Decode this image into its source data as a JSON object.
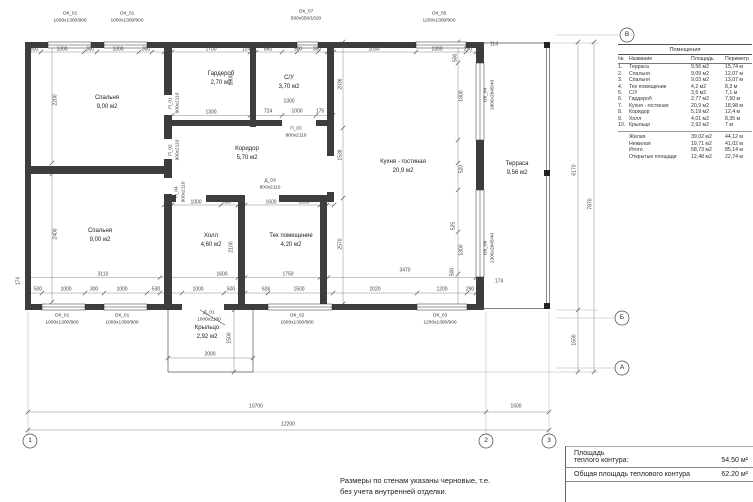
{
  "legend": {
    "title": "Помещения",
    "col_headers": [
      "№",
      "Название",
      "Площадь",
      "Периметр"
    ],
    "rows": [
      [
        "1.",
        "Терраса",
        "9,56 м2",
        "15,74 м"
      ],
      [
        "2.",
        "Спальня",
        "9,09 м2",
        "12,07 м"
      ],
      [
        "3.",
        "Спальня",
        "9,03 м2",
        "13,07 м"
      ],
      [
        "4.",
        "Тех помещение",
        "4,2 м2",
        "8,3 м"
      ],
      [
        "5.",
        "С/У",
        "3,5 м2",
        "7,1 м"
      ],
      [
        "6.",
        "Гардероб",
        "2,77 м2",
        "7,50 м"
      ],
      [
        "7.",
        "Кухня - гостиная",
        "20,9 м2",
        "18,98 м"
      ],
      [
        "8.",
        "Коридор",
        "5,19 м2",
        "12,4 м"
      ],
      [
        "9.",
        "Холл",
        "4,01 м2",
        "8,35 м"
      ],
      [
        "10.",
        "Крыльцо",
        "2,92 м2",
        "7 м"
      ]
    ],
    "summary": [
      [
        "Жилая",
        "39,02 м2",
        "44,12 м"
      ],
      [
        "Нежилая",
        "19,71 м2",
        "41,02 м"
      ],
      [
        "Итого",
        "58,73 м2",
        "85,14 м"
      ],
      [
        "Открытые площади",
        "12,48 м2",
        "22,74 м"
      ]
    ]
  },
  "info": {
    "label1a": "Площадь",
    "label1b": "теплого  контура:",
    "value1": "54.50 м²",
    "label2": "Общая площадь теплового контура",
    "value2": "62.20 м²"
  },
  "note": {
    "line1": "Размеры по стенам указаны черновые, т.е.",
    "line2": "без учета внутренней отделки."
  },
  "plan": {
    "labels": [
      {
        "n": "room-bedroom-1-name",
        "c": "room",
        "x": 107,
        "y": 98,
        "t": "Спальня"
      },
      {
        "n": "room-bedroom-1-area",
        "c": "room",
        "x": 107,
        "y": 107,
        "t": "9,00 м2"
      },
      {
        "n": "room-wardrobe-name",
        "c": "room",
        "x": 221,
        "y": 74,
        "t": "Гардероб"
      },
      {
        "n": "room-wardrobe-area",
        "c": "room",
        "x": 221,
        "y": 83,
        "t": "2,70 м2"
      },
      {
        "n": "room-bath-name",
        "c": "room",
        "x": 289,
        "y": 78,
        "t": "С/У"
      },
      {
        "n": "room-bath-area",
        "c": "room",
        "x": 289,
        "y": 87,
        "t": "3,70 м2"
      },
      {
        "n": "room-corridor-name",
        "c": "room",
        "x": 247,
        "y": 149,
        "t": "Коридор"
      },
      {
        "n": "room-corridor-area",
        "c": "room",
        "x": 247,
        "y": 158,
        "t": "5,70 м2"
      },
      {
        "n": "room-kitchen-name",
        "c": "room",
        "x": 403,
        "y": 162,
        "t": "Кухня - гостиная"
      },
      {
        "n": "room-kitchen-area",
        "c": "room",
        "x": 403,
        "y": 171,
        "t": "20,9 м2"
      },
      {
        "n": "room-terrace-name",
        "c": "room",
        "x": 517,
        "y": 164,
        "t": "Терраса"
      },
      {
        "n": "room-terrace-area",
        "c": "room",
        "x": 517,
        "y": 173,
        "t": "9,56 м2"
      },
      {
        "n": "room-bedroom-2-name",
        "c": "room",
        "x": 100,
        "y": 231,
        "t": "Спальня"
      },
      {
        "n": "room-bedroom-2-area",
        "c": "room",
        "x": 100,
        "y": 240,
        "t": "9,00 м2"
      },
      {
        "n": "room-hall-name",
        "c": "room",
        "x": 211,
        "y": 236,
        "t": "Холл"
      },
      {
        "n": "room-hall-area",
        "c": "room",
        "x": 211,
        "y": 245,
        "t": "4,60 м2"
      },
      {
        "n": "room-tech-name",
        "c": "room",
        "x": 291,
        "y": 236,
        "t": "Тех помещение"
      },
      {
        "n": "room-tech-area",
        "c": "room",
        "x": 291,
        "y": 245,
        "t": "4,20 м2"
      },
      {
        "n": "room-porch-name",
        "c": "room",
        "x": 207,
        "y": 328,
        "t": "Крыльцо"
      },
      {
        "n": "room-porch-area",
        "c": "room",
        "x": 207,
        "y": 337,
        "t": "2,92 м2"
      },
      {
        "n": "window-label",
        "c": "win",
        "x": 70,
        "y": 15,
        "t": "ОК_01"
      },
      {
        "n": "window-size",
        "c": "win",
        "x": 70,
        "y": 22,
        "t": "1000х1300/900"
      },
      {
        "n": "window-label",
        "c": "win",
        "x": 127,
        "y": 15,
        "t": "ОК_01"
      },
      {
        "n": "window-size",
        "c": "win",
        "x": 127,
        "y": 22,
        "t": "1000х1300/900"
      },
      {
        "n": "window-label",
        "c": "win",
        "x": 306,
        "y": 13,
        "t": "ОК_07"
      },
      {
        "n": "window-size",
        "c": "win",
        "x": 306,
        "y": 20,
        "t": "500х550/1620"
      },
      {
        "n": "window-label",
        "c": "win",
        "x": 439,
        "y": 15,
        "t": "ОК_05"
      },
      {
        "n": "window-size",
        "c": "win",
        "x": 439,
        "y": 22,
        "t": "1200х1300/900"
      },
      {
        "n": "window-label",
        "c": "win",
        "x": 62,
        "y": 317,
        "t": "ОК_01"
      },
      {
        "n": "window-size",
        "c": "win",
        "x": 62,
        "y": 324,
        "t": "1000х1300/900"
      },
      {
        "n": "window-label",
        "c": "win",
        "x": 122,
        "y": 317,
        "t": "ОК_01"
      },
      {
        "n": "window-size",
        "c": "win",
        "x": 122,
        "y": 324,
        "t": "1000х1300/900"
      },
      {
        "n": "door-label",
        "c": "win",
        "x": 209,
        "y": 314,
        "t": "Д_01"
      },
      {
        "n": "door-size",
        "c": "win",
        "x": 209,
        "y": 321,
        "t": "1000х2100"
      },
      {
        "n": "window-label",
        "c": "win",
        "x": 297,
        "y": 317,
        "t": "ОК_02"
      },
      {
        "n": "window-size",
        "c": "win",
        "x": 297,
        "y": 324,
        "t": "1600х1300/900"
      },
      {
        "n": "window-label",
        "c": "win",
        "x": 440,
        "y": 317,
        "t": "ОК_03"
      },
      {
        "n": "window-size",
        "c": "win",
        "x": 440,
        "y": 324,
        "t": "1200х1300/900"
      },
      {
        "n": "window-label",
        "c": "win",
        "x": 487,
        "y": 95,
        "t": "ОК_04",
        "r": 1
      },
      {
        "n": "window-size",
        "c": "win",
        "x": 494,
        "y": 95,
        "t": "1800х2845/40",
        "r": 1
      },
      {
        "n": "window-label",
        "c": "win",
        "x": 487,
        "y": 248,
        "t": "ОК_06",
        "r": 1
      },
      {
        "n": "window-size",
        "c": "win",
        "x": 494,
        "y": 248,
        "t": "1300х2845/40",
        "r": 1
      },
      {
        "n": "door-label",
        "c": "win",
        "x": 172,
        "y": 103,
        "t": "П_01",
        "r": 1
      },
      {
        "n": "door-size",
        "c": "win",
        "x": 179,
        "y": 103,
        "t": "900х2110",
        "r": 1
      },
      {
        "n": "door-label",
        "c": "win",
        "x": 172,
        "y": 150,
        "t": "П_02",
        "r": 1
      },
      {
        "n": "door-size",
        "c": "win",
        "x": 179,
        "y": 150,
        "t": "900х2110",
        "r": 1
      },
      {
        "n": "door-label",
        "c": "win",
        "x": 178,
        "y": 192,
        "t": "П_04",
        "r": 1
      },
      {
        "n": "door-size",
        "c": "win",
        "x": 185,
        "y": 192,
        "t": "900х2110",
        "r": 1
      },
      {
        "n": "door-label",
        "c": "win",
        "x": 296,
        "y": 130,
        "t": "П_03"
      },
      {
        "n": "door-size",
        "c": "win",
        "x": 296,
        "y": 137,
        "t": "800х2110"
      },
      {
        "n": "door-label",
        "c": "win",
        "x": 270,
        "y": 182,
        "t": "Д_03"
      },
      {
        "n": "door-size",
        "c": "win",
        "x": 270,
        "y": 189,
        "t": "800х2110"
      },
      {
        "n": "dim-label",
        "c": "dim",
        "x": 34,
        "y": 50,
        "t": "300"
      },
      {
        "n": "dim-label",
        "c": "dim",
        "x": 62,
        "y": 50,
        "t": "1000"
      },
      {
        "n": "dim-label",
        "c": "dim",
        "x": 90,
        "y": 50,
        "t": "300"
      },
      {
        "n": "dim-label",
        "c": "dim",
        "x": 118,
        "y": 50,
        "t": "1000"
      },
      {
        "n": "dim-label",
        "c": "dim",
        "x": 146,
        "y": 50,
        "t": "300"
      },
      {
        "n": "dim-label",
        "c": "dim",
        "x": 168,
        "y": 50,
        "t": "124"
      },
      {
        "n": "dim-label",
        "c": "dim",
        "x": 211,
        "y": 50,
        "t": "1700"
      },
      {
        "n": "dim-label",
        "c": "dim",
        "x": 246,
        "y": 50,
        "t": "124"
      },
      {
        "n": "dim-label",
        "c": "dim",
        "x": 268,
        "y": 50,
        "t": "860"
      },
      {
        "n": "dim-label",
        "c": "dim",
        "x": 298,
        "y": 50,
        "t": "500"
      },
      {
        "n": "dim-label",
        "c": "dim",
        "x": 317,
        "y": 50,
        "t": "300"
      },
      {
        "n": "dim-label",
        "c": "dim",
        "x": 374,
        "y": 50,
        "t": "2030"
      },
      {
        "n": "dim-label",
        "c": "dim",
        "x": 437,
        "y": 50,
        "t": "1300"
      },
      {
        "n": "dim-label",
        "c": "dim",
        "x": 468,
        "y": 50,
        "t": "290"
      },
      {
        "n": "dim-label",
        "c": "dim",
        "x": 494,
        "y": 45,
        "t": "114"
      },
      {
        "n": "dim-label",
        "c": "dim",
        "x": 232,
        "y": 80,
        "t": "1800",
        "r": 1
      },
      {
        "n": "dim-label",
        "c": "dim",
        "x": 211,
        "y": 113,
        "t": "1300"
      },
      {
        "n": "dim-label",
        "c": "dim",
        "x": 289,
        "y": 102,
        "t": "1300"
      },
      {
        "n": "dim-label",
        "c": "dim",
        "x": 268,
        "y": 112,
        "t": "724"
      },
      {
        "n": "dim-label",
        "c": "dim",
        "x": 297,
        "y": 112,
        "t": "1000"
      },
      {
        "n": "dim-label",
        "c": "dim",
        "x": 320,
        "y": 112,
        "t": "175"
      },
      {
        "n": "dim-label",
        "c": "dim",
        "x": 56,
        "y": 100,
        "t": "2200",
        "r": 1
      },
      {
        "n": "dim-label",
        "c": "dim",
        "x": 56,
        "y": 234,
        "t": "2400",
        "r": 1
      },
      {
        "n": "dim-label",
        "c": "dim",
        "x": 19,
        "y": 281,
        "t": "174",
        "r": 1
      },
      {
        "n": "dim-label",
        "c": "dim",
        "x": 341,
        "y": 84,
        "t": "2036",
        "r": 1
      },
      {
        "n": "dim-label",
        "c": "dim",
        "x": 341,
        "y": 155,
        "t": "1536",
        "r": 1
      },
      {
        "n": "dim-label",
        "c": "dim",
        "x": 341,
        "y": 244,
        "t": "2570",
        "r": 1
      },
      {
        "n": "dim-label",
        "c": "dim",
        "x": 232,
        "y": 247,
        "t": "2100",
        "r": 1
      },
      {
        "n": "dim-label",
        "c": "dim",
        "x": 196,
        "y": 203,
        "t": "1000"
      },
      {
        "n": "dim-label",
        "c": "dim",
        "x": 227,
        "y": 203,
        "t": "500"
      },
      {
        "n": "dim-label",
        "c": "dim",
        "x": 271,
        "y": 203,
        "t": "1600"
      },
      {
        "n": "dim-label",
        "c": "dim",
        "x": 304,
        "y": 203,
        "t": "1000"
      },
      {
        "n": "dim-label",
        "c": "dim",
        "x": 103,
        "y": 275,
        "t": "3110"
      },
      {
        "n": "dim-label",
        "c": "dim",
        "x": 222,
        "y": 275,
        "t": "1600"
      },
      {
        "n": "dim-label",
        "c": "dim",
        "x": 288,
        "y": 275,
        "t": "1750"
      },
      {
        "n": "dim-label",
        "c": "dim",
        "x": 405,
        "y": 271,
        "t": "3470"
      },
      {
        "n": "dim-label",
        "c": "dim",
        "x": 38,
        "y": 290,
        "t": "500"
      },
      {
        "n": "dim-label",
        "c": "dim",
        "x": 66,
        "y": 290,
        "t": "1000"
      },
      {
        "n": "dim-label",
        "c": "dim",
        "x": 94,
        "y": 290,
        "t": "300"
      },
      {
        "n": "dim-label",
        "c": "dim",
        "x": 122,
        "y": 290,
        "t": "1000"
      },
      {
        "n": "dim-label",
        "c": "dim",
        "x": 156,
        "y": 290,
        "t": "530"
      },
      {
        "n": "dim-label",
        "c": "dim",
        "x": 198,
        "y": 290,
        "t": "1000"
      },
      {
        "n": "dim-label",
        "c": "dim",
        "x": 231,
        "y": 290,
        "t": "500"
      },
      {
        "n": "dim-label",
        "c": "dim",
        "x": 266,
        "y": 290,
        "t": "626"
      },
      {
        "n": "dim-label",
        "c": "dim",
        "x": 299,
        "y": 290,
        "t": "1500"
      },
      {
        "n": "dim-label",
        "c": "dim",
        "x": 375,
        "y": 290,
        "t": "2020"
      },
      {
        "n": "dim-label",
        "c": "dim",
        "x": 442,
        "y": 290,
        "t": "1200"
      },
      {
        "n": "dim-label",
        "c": "dim",
        "x": 470,
        "y": 290,
        "t": "290"
      },
      {
        "n": "dim-label",
        "c": "dim",
        "x": 499,
        "y": 282,
        "t": "174"
      },
      {
        "n": "dim-label",
        "c": "dim",
        "x": 210,
        "y": 355,
        "t": "2000"
      },
      {
        "n": "dim-label",
        "c": "dim",
        "x": 230,
        "y": 338,
        "t": "1500",
        "r": 1
      },
      {
        "n": "dim-label",
        "c": "dim",
        "x": 456,
        "y": 58,
        "t": "506",
        "r": 1
      },
      {
        "n": "dim-label",
        "c": "dim",
        "x": 462,
        "y": 96,
        "t": "1800",
        "r": 1
      },
      {
        "n": "dim-label",
        "c": "dim",
        "x": 462,
        "y": 169,
        "t": "520",
        "r": 1
      },
      {
        "n": "dim-label",
        "c": "dim",
        "x": 454,
        "y": 226,
        "t": "525",
        "r": 1
      },
      {
        "n": "dim-label",
        "c": "dim",
        "x": 462,
        "y": 250,
        "t": "1300",
        "r": 1
      },
      {
        "n": "dim-label",
        "c": "dim",
        "x": 453,
        "y": 272,
        "t": "500",
        "r": 1
      },
      {
        "n": "dim-label",
        "c": "dim",
        "x": 575,
        "y": 170,
        "t": "6170",
        "r": 1
      },
      {
        "n": "dim-label",
        "c": "dim",
        "x": 591,
        "y": 204,
        "t": "7870",
        "r": 1
      },
      {
        "n": "dim-label",
        "c": "dim",
        "x": 575,
        "y": 340,
        "t": "1500",
        "r": 1
      },
      {
        "n": "dim-label",
        "c": "dim",
        "x": 256,
        "y": 407,
        "t": "10700"
      },
      {
        "n": "dim-label",
        "c": "dim",
        "x": 516,
        "y": 407,
        "t": "1500"
      },
      {
        "n": "dim-label",
        "c": "dim",
        "x": 288,
        "y": 425,
        "t": "12200"
      },
      {
        "n": "axis-letter-v",
        "c": "axis",
        "x": 627,
        "y": 35,
        "t": "В"
      },
      {
        "n": "axis-letter-b",
        "c": "axis",
        "x": 622,
        "y": 318,
        "t": "Б"
      },
      {
        "n": "axis-letter-a",
        "c": "axis",
        "x": 622,
        "y": 368,
        "t": "А"
      },
      {
        "n": "axis-number-1",
        "c": "axis",
        "x": 30,
        "y": 441,
        "t": "1"
      },
      {
        "n": "axis-number-2",
        "c": "axis",
        "x": 486,
        "y": 441,
        "t": "2"
      },
      {
        "n": "axis-number-3",
        "c": "axis",
        "x": 549,
        "y": 441,
        "t": "3"
      }
    ]
  }
}
